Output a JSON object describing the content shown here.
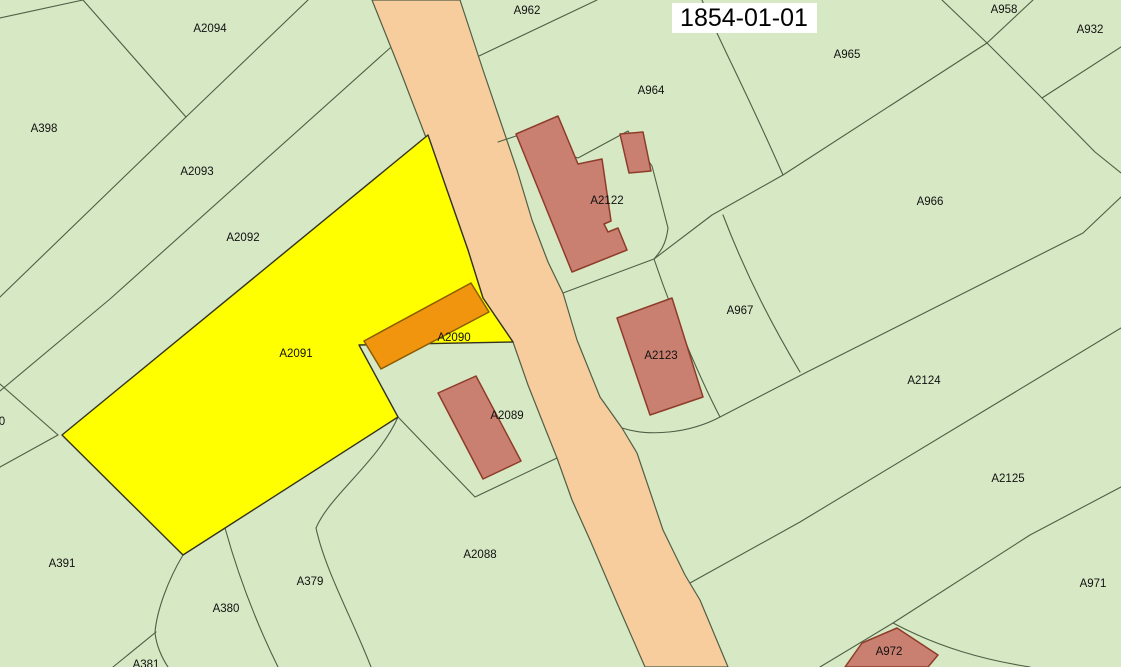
{
  "map": {
    "date_overlay": "1854-01-01",
    "highlighted_parcel": "A2091",
    "colors": {
      "parcel_green": "#d7e8c4",
      "road_fill": "#f8cd9e",
      "highlight_yellow": "#ffff00",
      "building_fill": "#ca8070",
      "building_stroke": "#8e3c2a",
      "orange_building_fill": "#f2950e",
      "orange_building_stroke": "#8a5c00",
      "boundary_line": "#4f5f46",
      "highlight_outline": "#33331f",
      "label_text": "#111111",
      "date_bg": "#ffffff",
      "date_text": "#000000"
    },
    "labels": [
      {
        "text": "A2094",
        "x": 210,
        "y": 28
      },
      {
        "text": "A962",
        "x": 527,
        "y": 10
      },
      {
        "text": "A958",
        "x": 1004,
        "y": 9
      },
      {
        "text": "A932",
        "x": 1090,
        "y": 29
      },
      {
        "text": "A965",
        "x": 847,
        "y": 54
      },
      {
        "text": "A964",
        "x": 651,
        "y": 90
      },
      {
        "text": "A398",
        "x": 44,
        "y": 128
      },
      {
        "text": "A2093",
        "x": 197,
        "y": 171
      },
      {
        "text": "A2122",
        "x": 607,
        "y": 200
      },
      {
        "text": "A966",
        "x": 930,
        "y": 201
      },
      {
        "text": "A2092",
        "x": 243,
        "y": 237
      },
      {
        "text": "A967",
        "x": 740,
        "y": 310
      },
      {
        "text": "A2090",
        "x": 454,
        "y": 337
      },
      {
        "text": "A2091",
        "x": 296,
        "y": 353
      },
      {
        "text": "A2123",
        "x": 661,
        "y": 355
      },
      {
        "text": "A2124",
        "x": 924,
        "y": 380
      },
      {
        "text": "A2089",
        "x": 507,
        "y": 415
      },
      {
        "text": "0",
        "x": 2,
        "y": 421
      },
      {
        "text": "A2125",
        "x": 1008,
        "y": 478
      },
      {
        "text": "A2088",
        "x": 480,
        "y": 554
      },
      {
        "text": "A391",
        "x": 62,
        "y": 563
      },
      {
        "text": "A379",
        "x": 310,
        "y": 581
      },
      {
        "text": "A971",
        "x": 1093,
        "y": 583
      },
      {
        "text": "A380",
        "x": 226,
        "y": 608
      },
      {
        "text": "A972",
        "x": 889,
        "y": 651
      },
      {
        "text": "A381",
        "x": 146,
        "y": 664
      }
    ]
  }
}
